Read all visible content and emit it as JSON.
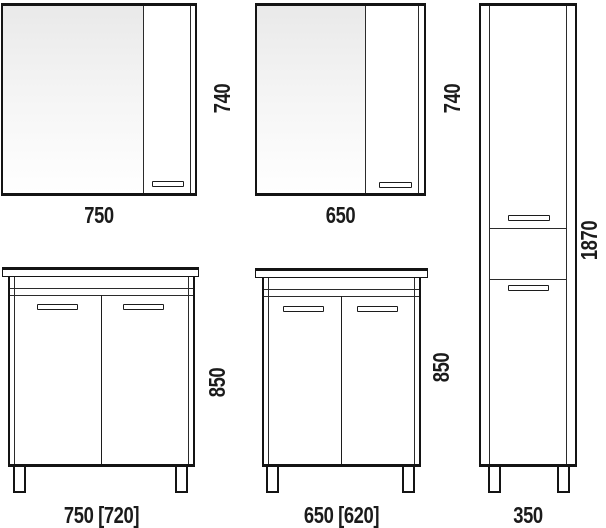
{
  "figures": {
    "mirror_cabinet_750": {
      "width": "750",
      "height": "740"
    },
    "mirror_cabinet_650": {
      "width": "650",
      "height": "740"
    },
    "tall_cabinet_350": {
      "width": "350",
      "height": "1870"
    },
    "vanity_750": {
      "width": "750 [720]",
      "height": "850"
    },
    "vanity_650": {
      "width": "650 [620]",
      "height": "850"
    }
  },
  "colors": {
    "line": "#141414",
    "text": "#1b1b1b",
    "background": "#ffffff",
    "mirror_gradient_top": "#e9e9e9",
    "mirror_gradient_bottom": "#ffffff"
  }
}
